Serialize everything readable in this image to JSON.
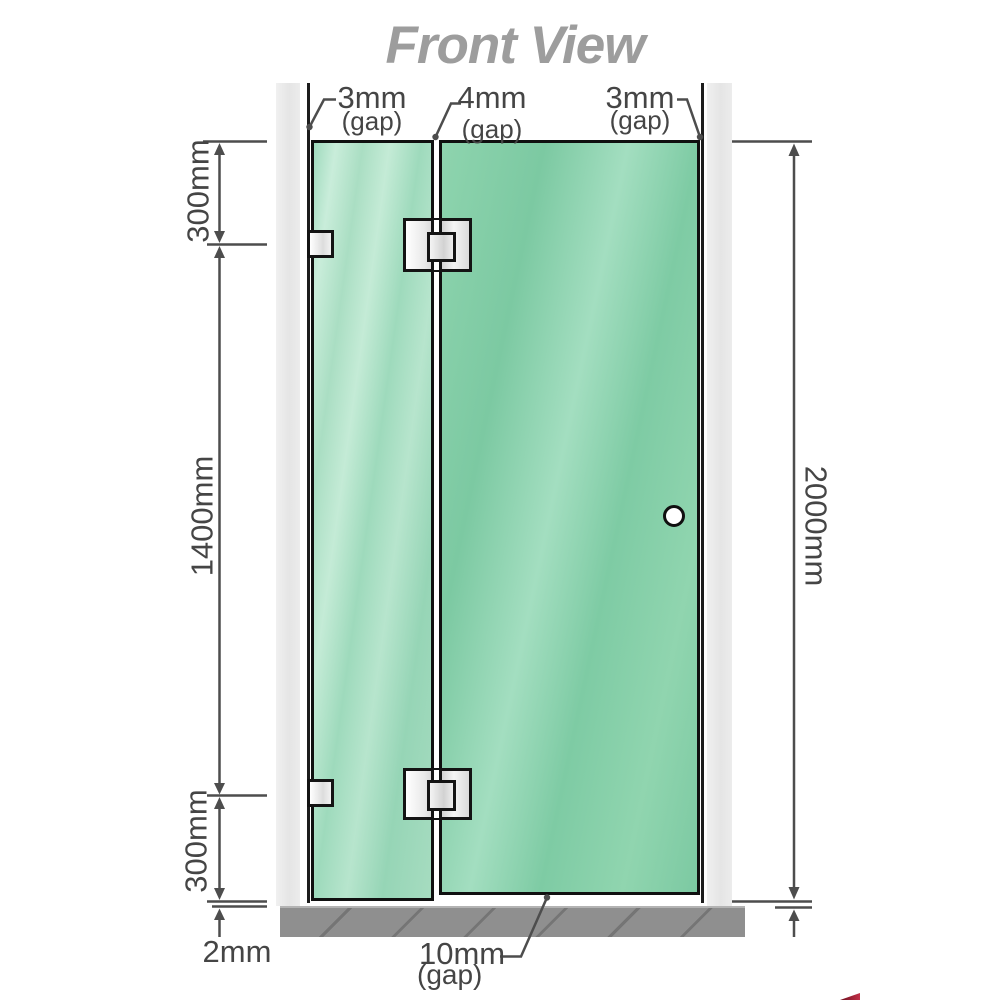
{
  "title": "Front View",
  "gap_labels": {
    "top_left": {
      "value": "3mm",
      "note": "(gap)"
    },
    "top_middle": {
      "value": "4mm",
      "note": "(gap)"
    },
    "top_right": {
      "value": "3mm",
      "note": "(gap)"
    },
    "bottom": {
      "value": "10mm",
      "note": "(gap)"
    },
    "floor": {
      "value": "2mm"
    }
  },
  "dimensions": {
    "left_top": "300mm",
    "left_middle": "1400mm",
    "left_bottom": "300mm",
    "right_overall": "2000mm"
  },
  "colors": {
    "glass_fixed_panel": "#a8ddc1",
    "glass_door_panel": "#82cda6",
    "wall_post": "#e9e9e9",
    "floor_base": "#8f8f8f",
    "dimension_lines": "#4d4d4d",
    "hardware_outline": "#141414",
    "title_text": "#9d9d9d",
    "brand_mark": "#8a1628"
  }
}
